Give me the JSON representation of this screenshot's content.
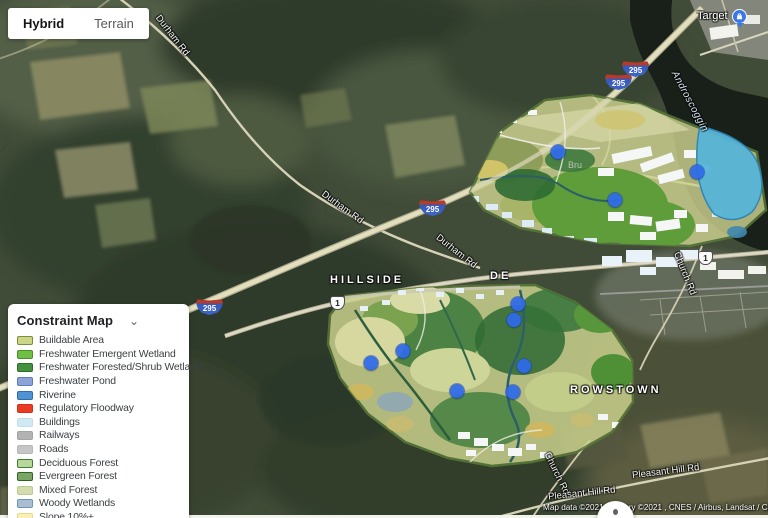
{
  "map_type_control": {
    "hybrid": "Hybrid",
    "terrain": "Terrain"
  },
  "legend": {
    "title": "Constraint Map",
    "collapse_icon": "⌄",
    "items": [
      {
        "label": "Buildable Area",
        "fill": "#ccd687",
        "border": "#7e8c42"
      },
      {
        "label": "Freshwater Emergent Wetland",
        "fill": "#6fbf44",
        "border": "#4b8f2f"
      },
      {
        "label": "Freshwater Forested/Shrub Wetland",
        "fill": "#43913f",
        "border": "#2f6d2b"
      },
      {
        "label": "Freshwater Pond",
        "fill": "#8ca3d8",
        "border": "#5c7cc0"
      },
      {
        "label": "Riverine",
        "fill": "#4f93d2",
        "border": "#2f6ca8"
      },
      {
        "label": "Regulatory Floodway",
        "fill": "#ea3b24",
        "border": "#d22f1b"
      },
      {
        "label": "Buildings",
        "fill": "#cfe9f5",
        "border": "#c2dcea"
      },
      {
        "label": "Railways",
        "fill": "#b3b3b3",
        "border": "#a3a3a3"
      },
      {
        "label": "Roads",
        "fill": "#c6c6c6",
        "border": "#b6b6b6"
      },
      {
        "label": "Deciduous Forest",
        "fill": "#b7d89a",
        "border": "#3e7d33"
      },
      {
        "label": "Evergreen Forest",
        "fill": "#79a763",
        "border": "#2f6327"
      },
      {
        "label": "Mixed Forest",
        "fill": "#d3dcae",
        "border": "#becb8e"
      },
      {
        "label": "Woody Wetlands",
        "fill": "#a9bfd1",
        "border": "#6f94b5"
      },
      {
        "label": "Slope 10%+",
        "fill": "#faf0b5",
        "border": "#e7d98e"
      }
    ]
  },
  "markers": {
    "color": "#2f6bea",
    "points": [
      {
        "x": 558,
        "y": 152
      },
      {
        "x": 697,
        "y": 172
      },
      {
        "x": 615,
        "y": 200
      },
      {
        "x": 518,
        "y": 304
      },
      {
        "x": 514,
        "y": 320
      },
      {
        "x": 403,
        "y": 351
      },
      {
        "x": 371,
        "y": 363
      },
      {
        "x": 524,
        "y": 366
      },
      {
        "x": 457,
        "y": 391
      },
      {
        "x": 513,
        "y": 392
      }
    ]
  },
  "route_shields": {
    "interstate": [
      {
        "label": "295",
        "x": 196,
        "y": 299
      },
      {
        "label": "295",
        "x": 419,
        "y": 200
      },
      {
        "label": "295",
        "x": 605,
        "y": 74
      },
      {
        "label": "295",
        "x": 622,
        "y": 61
      }
    ],
    "us_route": [
      {
        "label": "1",
        "x": 330,
        "y": 296
      },
      {
        "label": "1",
        "x": 698,
        "y": 251
      }
    ]
  },
  "map_labels": [
    {
      "text": "HILLSIDE",
      "x": 330,
      "y": 274,
      "rot": 0,
      "cls": "place"
    },
    {
      "text": "DE",
      "x": 490,
      "y": 270,
      "rot": 0,
      "cls": "place"
    },
    {
      "text": "ROWSTOWN",
      "x": 570,
      "y": 384,
      "rot": 0,
      "cls": "place"
    },
    {
      "text": "Durham Rd",
      "x": 148,
      "y": 30,
      "rot": 52,
      "cls": "road"
    },
    {
      "text": "Durham Rd",
      "x": 318,
      "y": 202,
      "rot": 36,
      "cls": "road"
    },
    {
      "text": "Durham Rd",
      "x": 432,
      "y": 246,
      "rot": 38,
      "cls": "road"
    },
    {
      "text": "Church Rd",
      "x": 662,
      "y": 268,
      "rot": 68,
      "cls": "road"
    },
    {
      "text": "Church Rd",
      "x": 534,
      "y": 468,
      "rot": 64,
      "cls": "road"
    },
    {
      "text": "Pleasant Hill Rd",
      "x": 632,
      "y": 466,
      "rot": -7,
      "cls": "road"
    },
    {
      "text": "Pleasant Hill Rd",
      "x": 548,
      "y": 488,
      "rot": -6,
      "cls": "road"
    },
    {
      "text": "Androscoggin",
      "x": 656,
      "y": 96,
      "rot": 62,
      "cls": "water"
    },
    {
      "text": "Bru",
      "x": 568,
      "y": 160,
      "rot": 0,
      "cls": "faint"
    }
  ],
  "poi": {
    "label": "Target",
    "icon": "shopping-bag-icon"
  },
  "attribution": {
    "text": "Map data ©2021 Imagery ©2021 , CNES / Airbus, Landsat / Copernicus"
  }
}
